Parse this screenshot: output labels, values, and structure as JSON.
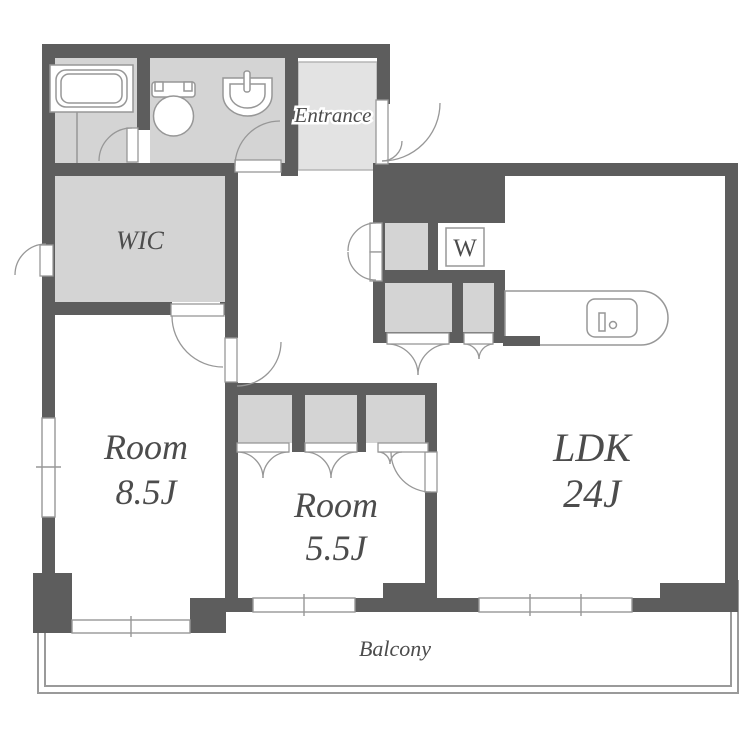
{
  "plan": {
    "type": "apartment-floor-plan",
    "labels": {
      "entrance": "Entrance",
      "wic": "WIC",
      "washer": "W",
      "room1_name": "Room",
      "room1_size": "8.5J",
      "room2_name": "Room",
      "room2_size": "5.5J",
      "ldk_name": "LDK",
      "ldk_size": "24J",
      "balcony": "Balcony"
    },
    "rooms": [
      {
        "name": "LDK",
        "size_tatami": "24J"
      },
      {
        "name": "Room",
        "size_tatami": "8.5J"
      },
      {
        "name": "Room",
        "size_tatami": "5.5J"
      },
      {
        "name": "WIC"
      },
      {
        "name": "Entrance"
      },
      {
        "name": "Balcony"
      },
      {
        "name": "W",
        "meaning": "washing-machine-space"
      }
    ],
    "colors": {
      "wall": "#5d5d5d",
      "room_grey": "#d4d4d4",
      "entrance_floor": "#e3e3e3",
      "line": "#979797",
      "balcony_line": "#9a9a9a",
      "text": "#4c4c4c",
      "bg": "#ffffff",
      "halo": "#ffffff"
    }
  }
}
